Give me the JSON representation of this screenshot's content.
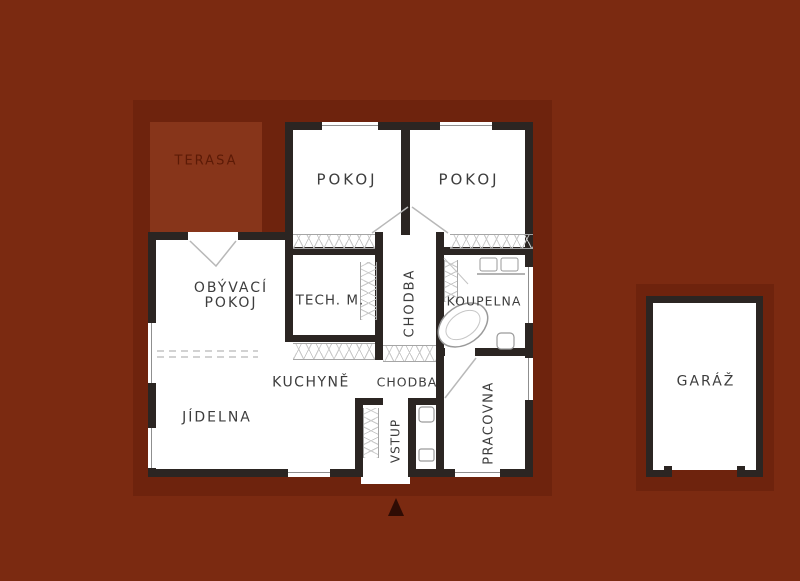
{
  "title": "floor-plan",
  "palette": {
    "background": "#7b2a11",
    "roof_band": "#6e230d",
    "terrace_fill": "#87351a",
    "wall": "#2b2522",
    "floor": "#ffffff",
    "symbol_lines": "#b0b0b0",
    "label_text": "#3d3d3d",
    "terrace_text": "#5c1a06",
    "entrance_arrow": "#2f0c04"
  },
  "labels": {
    "terasa": "TERASA",
    "pokoj_left": "POKOJ",
    "pokoj_right": "POKOJ",
    "obyvaci_line1": "OBÝVACÍ",
    "obyvaci_line2": "POKOJ",
    "tech": "TECH. M.",
    "chodba_vertical": "CHODBA",
    "koupelna": "KOUPELNA",
    "kuchyne": "KUCHYNĚ",
    "chodba_horizontal": "CHODBA",
    "jidelna": "JÍDELNA",
    "vstup": "VSTUP",
    "pracovna": "PRACOVNA",
    "garaz": "GARÁŽ"
  }
}
